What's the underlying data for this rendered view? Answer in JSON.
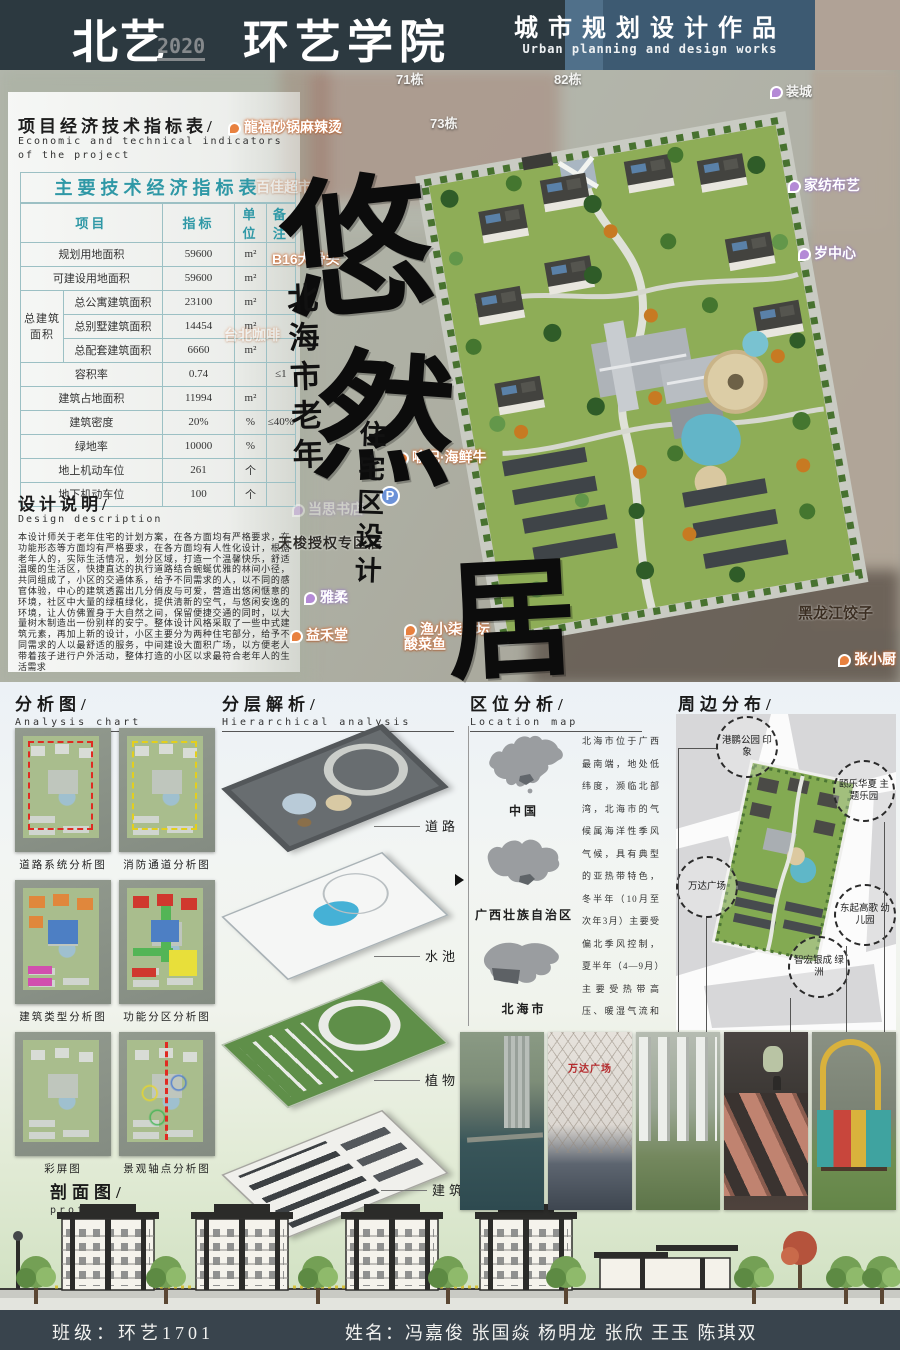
{
  "colors": {
    "header_dark": "#2c3940",
    "header_blue": "#3d5a72",
    "header_tan": "#b0a296",
    "table_teal": "#2f98a6",
    "footer_bg": "#39444d"
  },
  "header": {
    "logo": "北艺",
    "year": "2020",
    "college": "环艺学院",
    "title_cn": "城市规划设计作品",
    "title_en": "Urban planning and design works"
  },
  "indicators": {
    "title_cn": "项目经济技术指标表/",
    "title_en1": "Economic and technical indicators",
    "title_en2": "of the project",
    "table": {
      "caption": "主要技术经济指标表",
      "col_project": "项目",
      "col_value": "指标",
      "col_unit": "单位",
      "col_note": "备注",
      "group_label": "总建筑 面积",
      "rows": [
        {
          "label": "规划用地面积",
          "value": "59600",
          "unit": "m²",
          "note": ""
        },
        {
          "label": "可建设用地面积",
          "value": "59600",
          "unit": "m²",
          "note": ""
        },
        {
          "label": "总公寓建筑面积",
          "value": "23100",
          "unit": "m²",
          "note": ""
        },
        {
          "label": "总别墅建筑面积",
          "value": "14454",
          "unit": "m²",
          "note": ""
        },
        {
          "label": "总配套建筑面积",
          "value": "6660",
          "unit": "m²",
          "note": ""
        },
        {
          "label": "容积率",
          "value": "0.74",
          "unit": "",
          "note": "≤1"
        },
        {
          "label": "建筑占地面积",
          "value": "11994",
          "unit": "m²",
          "note": ""
        },
        {
          "label": "建筑密度",
          "value": "20%",
          "unit": "%",
          "note": "≤40%"
        },
        {
          "label": "绿地率",
          "value": "10000",
          "unit": "%",
          "note": ""
        },
        {
          "label": "地上机动车位",
          "value": "261",
          "unit": "个",
          "note": ""
        },
        {
          "label": "地下机动车位",
          "value": "100",
          "unit": "个",
          "note": ""
        }
      ]
    }
  },
  "design": {
    "title_cn": "设计说明/",
    "title_en": "Design description",
    "body": "本设计师关于老年住宅的计划方案，在各方面均有严格要求，在功能形态等方面均有严格要求，在各方面均有人性化设计，根据老年人的，实际生活情况，划分区域，打造一个温馨快乐，舒适温暖的生活区，快捷直达的执行道路结合蜿蜒优雅的林间小径，共同组成了，小区的交通体系，给予不同需求的人，以不同的感官体验，中心的建筑透露出几分俏皮与可爱，营造出悠闲惬意的环境，社区中大量的绿植绿化，提供清新的空气，与悠闲安逸的环境，让人仿佛置身于大自然之间，保留便捷交通的同时，以大量树木制造出一份别样的安宁。整体设计风格采取了一些中式建筑元素，再加上新的设计，小区主要分为两种住宅部分，给予不同需求的人以最舒适的服务，中间建设大面积广场，以方便老人带着孩子进行户外活动，整体打造的小区以求最符合老年人的生活需求"
  },
  "calligraphy": {
    "chars": [
      {
        "ch": "悠",
        "x": 280,
        "y": 128,
        "size": 150,
        "variant": "r1"
      },
      {
        "ch": "然",
        "x": 316,
        "y": 308,
        "size": 140,
        "variant": "r2"
      },
      {
        "ch": "居",
        "x": 446,
        "y": 515,
        "size": 130,
        "variant": "r3"
      }
    ],
    "sub1": "北海市老年",
    "sub2": "住宅区设计"
  },
  "site_area": {
    "map_labels": [
      {
        "text": "71栋",
        "x": 396,
        "y": 72,
        "variant": "lw"
      },
      {
        "text": "82栋",
        "x": 554,
        "y": 72,
        "variant": "lw"
      },
      {
        "text": "73栋",
        "x": 430,
        "y": 116,
        "variant": "lw"
      },
      {
        "text": "装城",
        "x": 770,
        "y": 84,
        "variant": "lw ic-purple"
      },
      {
        "text": "家纺布艺",
        "x": 788,
        "y": 178,
        "variant": "lp ic-purple"
      },
      {
        "text": "岁中心",
        "x": 798,
        "y": 246,
        "variant": "lp ic-purple"
      },
      {
        "text": "龍福砂锅麻辣烫",
        "x": 228,
        "y": 120,
        "variant": "lo ic-orange"
      },
      {
        "text": "百佳超市",
        "x": 256,
        "y": 180,
        "variant": "lo faded"
      },
      {
        "text": "B16大骨头",
        "x": 272,
        "y": 252,
        "variant": "lo"
      },
      {
        "text": "台北咖啡",
        "x": 224,
        "y": 328,
        "variant": "lo faded"
      },
      {
        "text": "喻记·海鲜牛",
        "x": 396,
        "y": 450,
        "variant": "lo ic-orange"
      },
      {
        "text": "P",
        "x": 380,
        "y": 486,
        "variant": "parking"
      },
      {
        "text": "当思书店",
        "x": 292,
        "y": 502,
        "variant": "lp faded ic-purple"
      },
      {
        "text": "天梭授权专区店",
        "x": 278,
        "y": 536,
        "variant": "ld"
      },
      {
        "text": "雅柔",
        "x": 304,
        "y": 590,
        "variant": "lp ic-purple"
      },
      {
        "text": "益禾堂",
        "x": 290,
        "y": 628,
        "variant": "lo ic-orange"
      },
      {
        "text": "渔小柒老坛\n酸菜鱼",
        "x": 404,
        "y": 622,
        "variant": "lo ic-orange"
      },
      {
        "text": "黑龙江饺子",
        "x": 798,
        "y": 606,
        "variant": "ld2"
      },
      {
        "text": "张小厨",
        "x": 838,
        "y": 652,
        "variant": "lo ic-orange"
      }
    ]
  },
  "analysis": {
    "title_cn": "分析图/",
    "title_en": "Analysis chart",
    "items": [
      {
        "caption": "道路系统分析图",
        "variant": "v-road"
      },
      {
        "caption": "消防通道分析图",
        "variant": "v-fire"
      },
      {
        "caption": "建筑类型分析图",
        "variant": "v-type"
      },
      {
        "caption": "功能分区分析图",
        "variant": "v-zone"
      },
      {
        "caption": "彩屏图",
        "variant": "v-color"
      },
      {
        "caption": "景观轴点分析图",
        "variant": "v-axis"
      }
    ]
  },
  "hierarchy": {
    "title_cn": "分层解析/",
    "title_en": "Hierarchical analysis",
    "labels": [
      {
        "label": "道路",
        "x": 425,
        "y": 816
      },
      {
        "label": "水池",
        "x": 425,
        "y": 946
      },
      {
        "label": "植物",
        "x": 425,
        "y": 1070
      },
      {
        "label": "建筑",
        "x": 432,
        "y": 1180
      }
    ]
  },
  "location": {
    "title_cn": "区位分析/",
    "title_en": "Location map",
    "maps": [
      {
        "label": "中国"
      },
      {
        "label": "广西壮族自治区"
      },
      {
        "label": "北海市"
      }
    ],
    "text": "北海市位于广西最南端，地处低纬度，濒临北部湾，北海市的气候属海洋性季风气候，具有典型的亚热带特色，冬半年（10月至次年3月）主要受偏北季风控制，夏半年（4—9月）主要受热带高压、暖湿气流和偏南风影响，冬春相连，长夏无冬，夏无酷暑，气候宜人。"
  },
  "peripheral": {
    "title_cn": "周边分布/",
    "title_en": "Peripheral distribution",
    "places": [
      {
        "text": "港鹏公园 印象",
        "x": 716,
        "y": 716
      },
      {
        "text": "颐乐华夏 主题乐园",
        "x": 833,
        "y": 760
      },
      {
        "text": "万达广场",
        "x": 676,
        "y": 856
      },
      {
        "text": "东起高歌 幼儿园",
        "x": 834,
        "y": 884
      },
      {
        "text": "智宏银成 绿洲",
        "x": 788,
        "y": 936
      }
    ]
  },
  "photos": {
    "items": [
      {
        "variant": "p-pond",
        "name": "park-pond-photo"
      },
      {
        "variant": "p-mall",
        "label": "万达广场",
        "name": "wanda-plaza-photo"
      },
      {
        "variant": "p-aerial",
        "label": "",
        "name": "residential-aerial-photo"
      },
      {
        "variant": "p-tramp",
        "name": "trampoline-park-photo"
      },
      {
        "variant": "p-play",
        "name": "playground-photo"
      }
    ]
  },
  "profile": {
    "title_cn": "剖面图/",
    "title_en": "profile"
  },
  "footer": {
    "class_label": "班级：环艺1701",
    "names_label": "姓名：冯嘉俊  张国焱  杨明龙  张欣  王玉  陈琪双"
  }
}
